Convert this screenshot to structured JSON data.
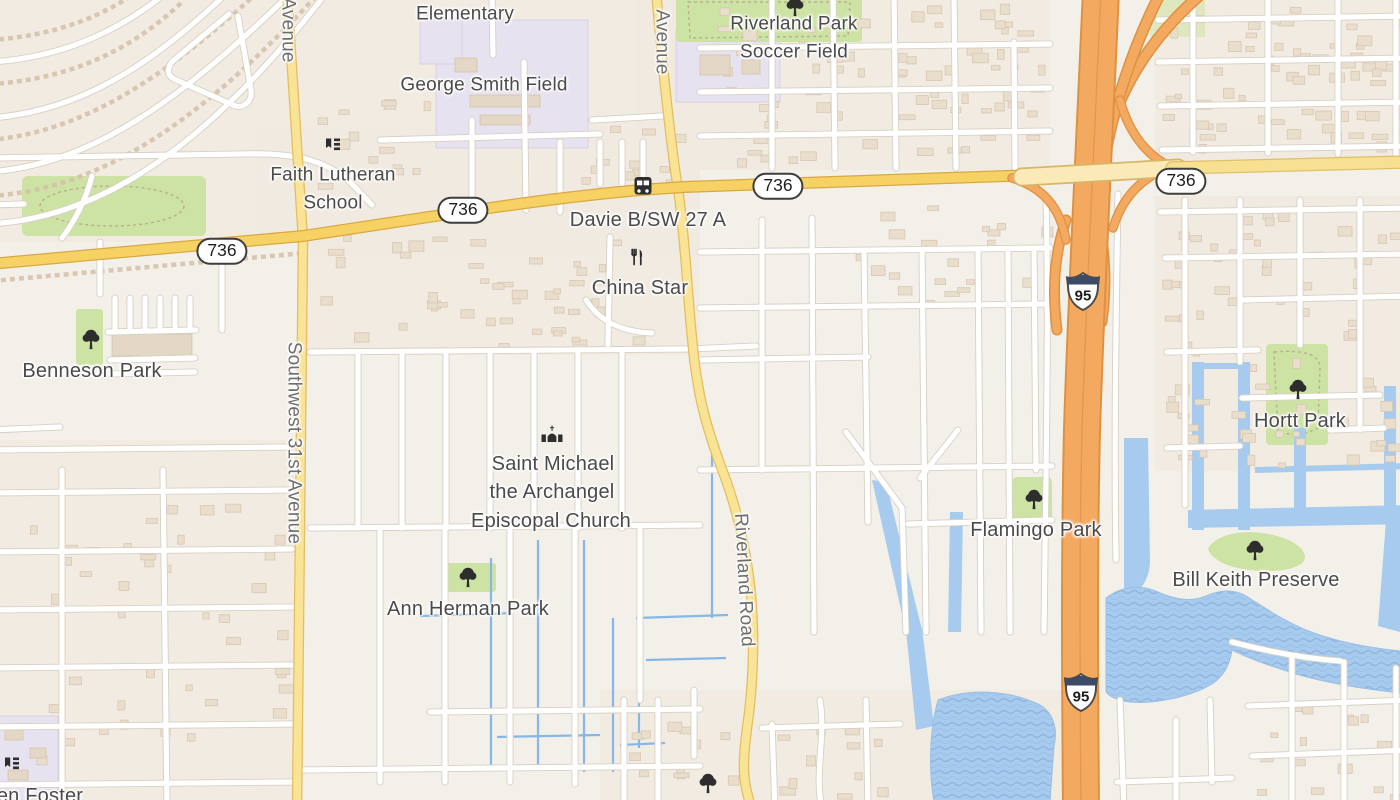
{
  "map": {
    "place_labels": {
      "elementary": "Elementary",
      "george_smith_field": "George Smith Field",
      "riverland_park_line1": "Riverland Park",
      "riverland_park_line2": "Soccer Field",
      "faith_lutheran_line1": "Faith Lutheran",
      "faith_lutheran_line2": "School",
      "davie_stop": "Davie B/SW 27 A",
      "china_star": "China Star",
      "benneson_park": "Benneson Park",
      "saint_michael_line1": "Saint Michael",
      "saint_michael_line2": "the Archangel",
      "saint_michael_line3": "Episcopal Church",
      "ann_herman_park": "Ann Herman Park",
      "flamingo_park": "Flamingo Park",
      "hortt_park": "Hortt Park",
      "bill_keith_preserve": "Bill Keith Preserve",
      "foster_partial": "en Foster"
    },
    "road_labels": {
      "sw31_avenue": "Southwest 31st Avenue",
      "avenue_top_left": "Avenue",
      "avenue_center": "Avenue",
      "riverland_road": "Riverland Road"
    },
    "shields": {
      "route_736": "736",
      "i95": "95"
    },
    "icons": {
      "poi_icon_names": [
        "tree-icon",
        "bus-icon",
        "restaurant-icon",
        "church-icon",
        "school-icon"
      ]
    },
    "colors": {
      "land": "#f3f0e9",
      "residential": "#efe8dd",
      "motorway": "#f4a960",
      "motorway_casing": "#de9140",
      "primary_road": "#f5d263",
      "secondary_road": "#f9e394",
      "bridge_road": "#faeab8",
      "water": "#a6cbee",
      "canal": "#85b7e8",
      "park": "#cde3a3",
      "school_area": "#e7e2f0",
      "building": "#e9ddcc",
      "label_text": "#4a4a4a",
      "road_label_text": "#6e6e6e"
    }
  }
}
